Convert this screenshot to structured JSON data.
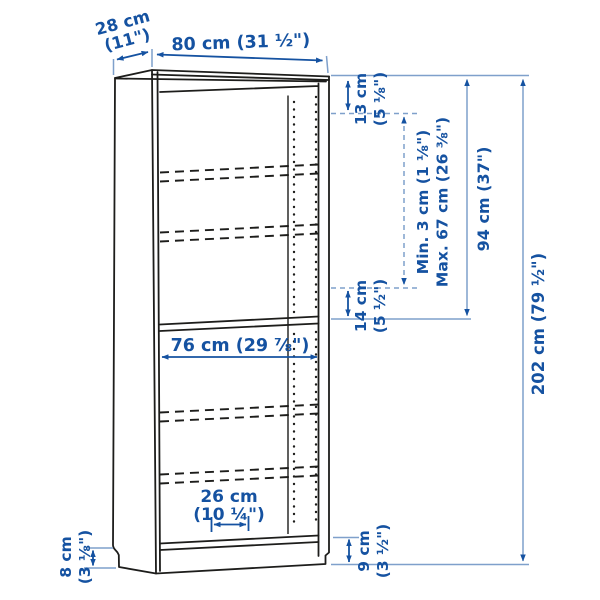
{
  "diagram": {
    "kind": "bookcase-dimension-diagram",
    "labels": {
      "depth_1": "28 cm",
      "depth_2": "(11\")",
      "width": "80 cm (31 ½\")",
      "top_offset_1": "13 cm",
      "top_offset_2": "(5 ⅛\")",
      "shelf_min": "Min. 3 cm (1 ⅛\")",
      "shelf_max": "Max. 67 cm (26 ⅜\")",
      "upper_height": "94 cm (37\")",
      "total_height": "202 cm (79 ½\")",
      "mid_offset_1": "14 cm",
      "mid_offset_2": "(5 ½\")",
      "inner_width": "76 cm (29 ⅞\")",
      "shelf_depth_1": "26 cm",
      "shelf_depth_2": "(10 ¼\")",
      "plinth_left_1": "8 cm",
      "plinth_left_2": "(3 ⅛\")",
      "plinth_right_1": "9 cm",
      "plinth_right_2": "(3 ½\")"
    },
    "colors": {
      "dimension_text": "#1552a1",
      "dimension_arrow": "#1552a1",
      "extension_line": "#7fa0cb",
      "drawing_line": "#1d1d1b",
      "background": "#ffffff"
    }
  }
}
